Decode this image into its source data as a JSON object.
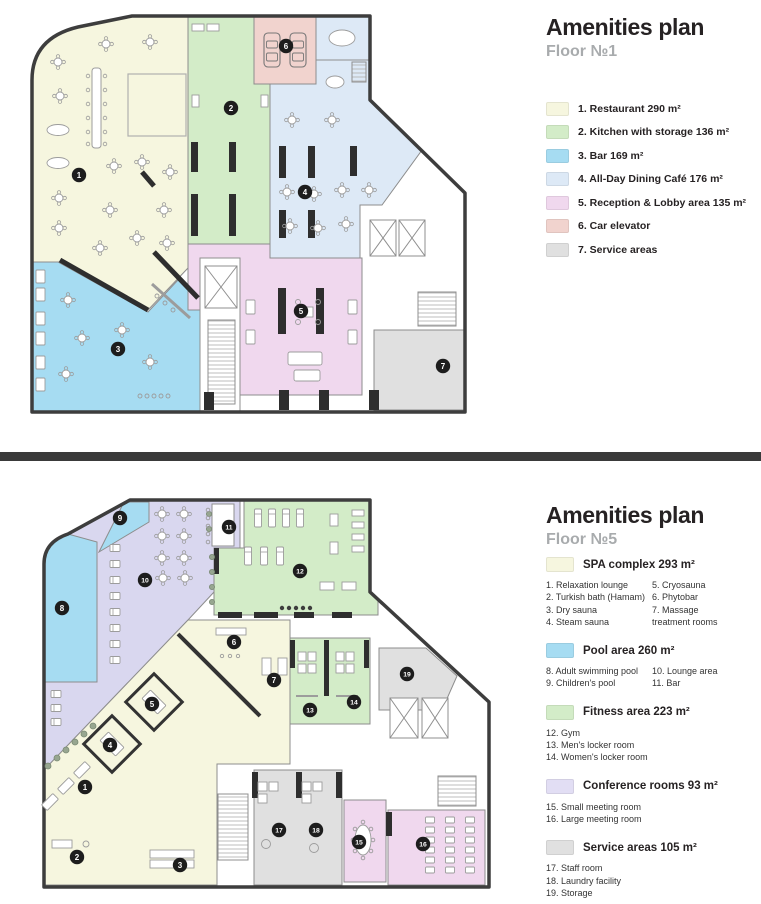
{
  "floor1": {
    "title": "Amenities plan",
    "subtitle": "Floor №1",
    "legend": [
      {
        "label": "1. Restaurant 290 m²",
        "color": "#f6f6df"
      },
      {
        "label": "2. Kitchen with storage 136 m²",
        "color": "#d3ecc8"
      },
      {
        "label": "3. Bar 169 m²",
        "color": "#a6dcf2"
      },
      {
        "label": "4. All-Day Dining Café 176 m²",
        "color": "#dde9f6"
      },
      {
        "label": "5. Reception & Lobby area 135 m²",
        "color": "#f0d8ee"
      },
      {
        "label": "6. Car elevator",
        "color": "#f1d3ce"
      },
      {
        "label": "7. Service areas",
        "color": "#e0e0e0"
      }
    ],
    "markers": [
      "1",
      "2",
      "3",
      "4",
      "5",
      "6",
      "7"
    ]
  },
  "floor5": {
    "title": "Amenities plan",
    "subtitle": "Floor №5",
    "groups": [
      {
        "label": "SPA complex 293 m²",
        "color": "#f6f6df",
        "col1": [
          "1. Relaxation lounge",
          "2. Turkish bath (Hamam)",
          "3. Dry sauna",
          "4. Steam sauna"
        ],
        "col2": [
          "5. Cryosauna",
          "6. Phytobar",
          "7. Massage",
          "treatment rooms"
        ]
      },
      {
        "label": "Pool area 260 m²",
        "color": "#a6dcf2",
        "col1": [
          "8. Adult swimming pool",
          "9. Children's pool"
        ],
        "col2": [
          "10. Lounge area",
          "11. Bar"
        ]
      },
      {
        "label": "Fitness area 223 m²",
        "color": "#d3ecc8",
        "col1": [
          "12. Gym",
          "13. Men's locker room",
          "14. Women's locker room"
        ],
        "col2": []
      },
      {
        "label": "Conference rooms 93 m²",
        "color": "#e2def4",
        "col1": [
          "15. Small meeting room",
          "16. Large meeting room"
        ],
        "col2": []
      },
      {
        "label": "Service areas 105 m²",
        "color": "#e0e0e0",
        "col1": [
          "17. Staff room",
          "18. Laundry facility",
          "19. Storage"
        ],
        "col2": []
      }
    ],
    "markers": [
      "1",
      "2",
      "3",
      "4",
      "5",
      "6",
      "7",
      "8",
      "9",
      "10",
      "11",
      "12",
      "13",
      "14",
      "15",
      "16",
      "17",
      "18",
      "19"
    ]
  }
}
